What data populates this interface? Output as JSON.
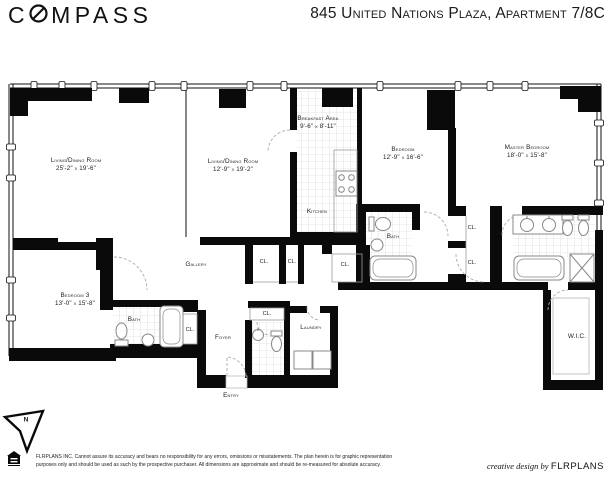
{
  "header": {
    "logo_prefix": "C",
    "logo_suffix": "MPASS",
    "title": "845 United Nations Plaza, Apartment 7/8C"
  },
  "plan": {
    "north_label": "N",
    "closet_label": "CL.",
    "rooms": [
      {
        "id": "living-dining-1",
        "name": "Living/Dining Room",
        "dims": "25'-2\" x 19'-6\""
      },
      {
        "id": "living-dining-2",
        "name": "Living/Dining Room",
        "dims": "12'-9\" x 19'-2\""
      },
      {
        "id": "breakfast-area",
        "name": "Breakfast Area",
        "dims": "9'-6\" x 8'-11\""
      },
      {
        "id": "kitchen",
        "name": "Kitchen",
        "dims": ""
      },
      {
        "id": "bedroom",
        "name": "Bedroom",
        "dims": "12'-9\" x 16'-6\""
      },
      {
        "id": "master-bedroom",
        "name": "Master Bedroom",
        "dims": "18'-0\" x 15'-8\""
      },
      {
        "id": "bedroom-3",
        "name": "Bedroom 3",
        "dims": "13'-0\" x 15'-8\""
      },
      {
        "id": "bath-bedroom-3",
        "name": "Bath",
        "dims": ""
      },
      {
        "id": "bath-bedroom",
        "name": "Bath",
        "dims": ""
      },
      {
        "id": "gallery",
        "name": "Gallery",
        "dims": ""
      },
      {
        "id": "foyer",
        "name": "Foyer",
        "dims": ""
      },
      {
        "id": "laundry",
        "name": "Laundry",
        "dims": ""
      },
      {
        "id": "entry",
        "name": "Entry",
        "dims": ""
      },
      {
        "id": "wic",
        "name": "W.I.C.",
        "dims": ""
      }
    ]
  },
  "footer": {
    "disclaimer_line1": "FLRPLANS INC. Cannot assure its accuracy and bears no responsibility for any errors, omissions or misstatements. The plan herein is for graphic representation",
    "disclaimer_line2": "purposes only and should be used as such by the prospective purchaser. All dimensions are approximate and should be re-measured for absolute accuracy.",
    "credit_prefix": "creative design by",
    "credit_brand": "FLRPLANS"
  }
}
